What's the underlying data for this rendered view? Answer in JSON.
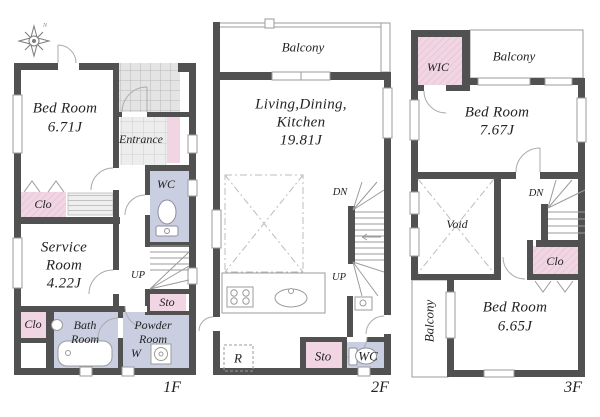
{
  "compass": {
    "north_label": "N"
  },
  "floor_1": {
    "floor_label": "1F",
    "bed_room": {
      "name": "Bed Room",
      "size": "6.71J"
    },
    "entrance_label": "Entrance",
    "wc_label": "WC",
    "closet_upper_label": "Clo",
    "service_room": {
      "line1": "Service",
      "line2": "Room",
      "size": "4.22J"
    },
    "up_label": "UP",
    "storage_label": "Sto",
    "closet_lower_label": "Clo",
    "bath_room": {
      "line1": "Bath",
      "line2": "Room"
    },
    "powder_room": {
      "line1": "Powder",
      "line2": "Room"
    },
    "washer_label": "W"
  },
  "floor_2": {
    "floor_label": "2F",
    "balcony_label": "Balcony",
    "ldk": {
      "line1": "Living,Dining,",
      "line2": "Kitchen",
      "size": "19.81J"
    },
    "down_label": "DN",
    "up_label": "UP",
    "refrigerator_label": "R",
    "storage_label": "Sto",
    "wc_label": "WC"
  },
  "floor_3": {
    "floor_label": "3F",
    "wic_label": "WIC",
    "balcony_top_label": "Balcony",
    "bed_room_1": {
      "name": "Bed Room",
      "size": "7.67J"
    },
    "down_label": "DN",
    "void_label": "Void",
    "closet_label": "Clo",
    "balcony_left_label": "Balcony",
    "bed_room_2": {
      "name": "Bed Room",
      "size": "6.65J"
    }
  },
  "colors": {
    "wall": "#515151",
    "closet_pink": "#f1d5e3",
    "wet_area_lavender": "#c9cee1",
    "line_gray": "#9b9b9b"
  }
}
